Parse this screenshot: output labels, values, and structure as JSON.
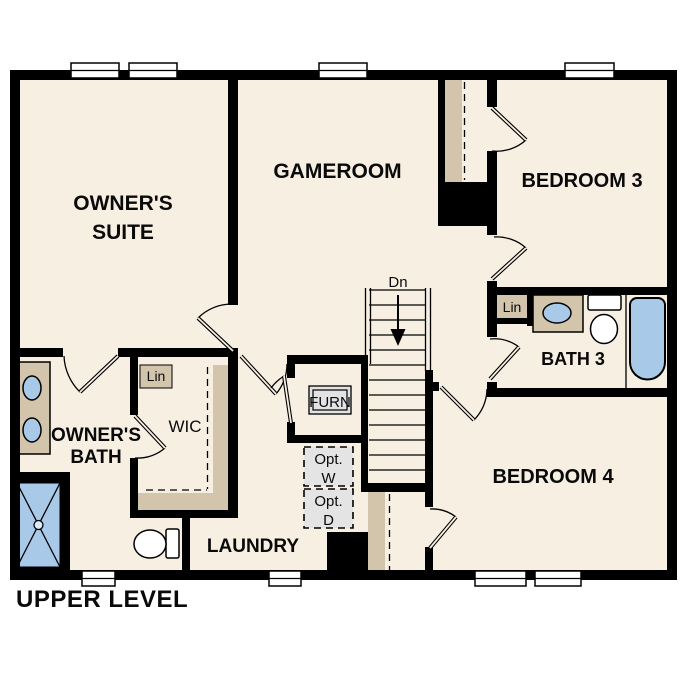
{
  "plan": {
    "title": "UPPER LEVEL",
    "rooms": {
      "owners_suite": {
        "line1": "OWNER'S",
        "line2": "SUITE"
      },
      "gameroom": {
        "label": "GAMEROOM"
      },
      "bedroom3": {
        "label": "BEDROOM 3"
      },
      "bath3": {
        "label": "BATH 3"
      },
      "bedroom4": {
        "label": "BEDROOM 4"
      },
      "owners_bath": {
        "line1": "OWNER'S",
        "line2": "BATH"
      },
      "wic": {
        "label": "WIC"
      },
      "laundry": {
        "label": "LAUNDRY"
      }
    },
    "closets": {
      "furnace": {
        "label": "FURN"
      },
      "linen_wic": {
        "label": "Lin"
      },
      "linen_bath3": {
        "label": "Lin"
      }
    },
    "optional_appliances": {
      "washer": {
        "line1": "Opt.",
        "line2": "W"
      },
      "dryer": {
        "line1": "Opt.",
        "line2": "D"
      }
    },
    "stairs": {
      "direction": "Dn"
    },
    "colors": {
      "floor": "#f7efe2",
      "wall": "#000000",
      "casework_tan": "#d3c5ac",
      "fixture_blue": "#a9c9e9",
      "optional_gray": "#e4e4e4"
    }
  }
}
